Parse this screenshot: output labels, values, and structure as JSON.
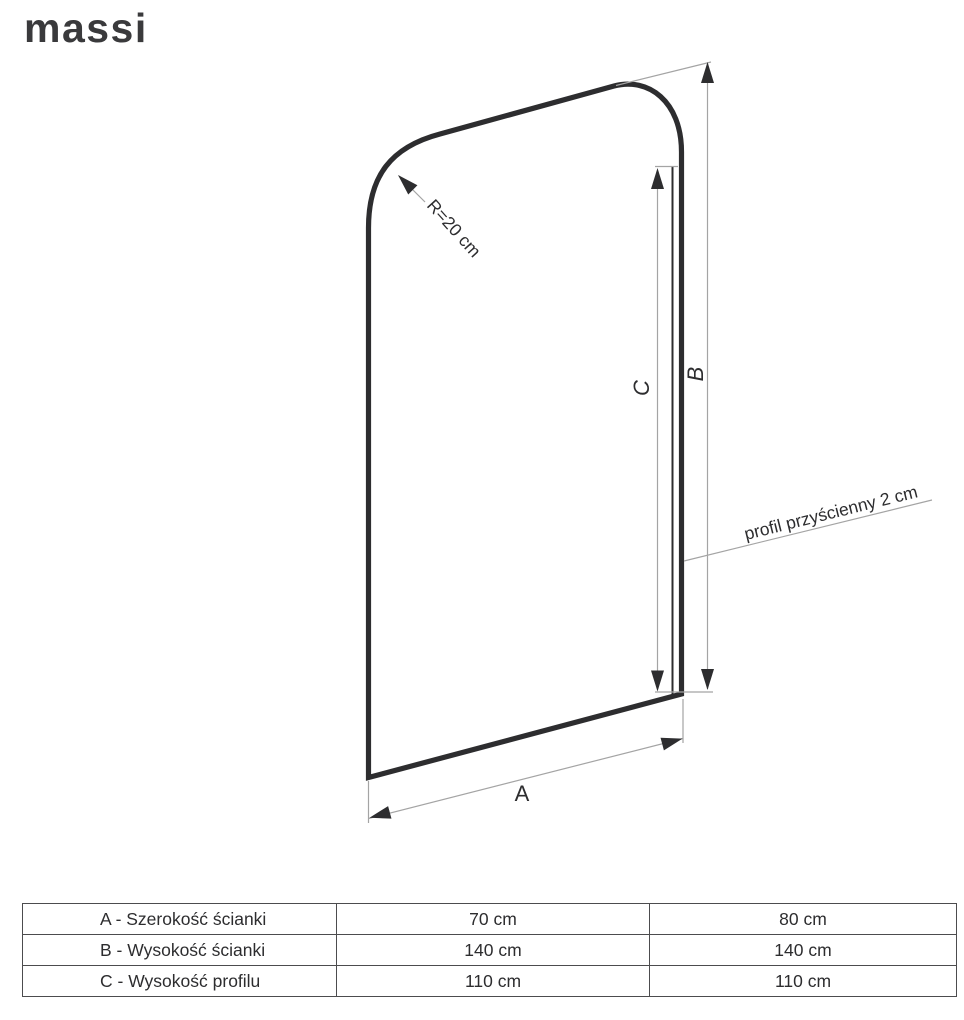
{
  "brand": {
    "logo_text": "massi"
  },
  "diagram": {
    "radius_label": "R=20 cm",
    "profile_label": "profil przyścienny 2 cm",
    "dim_a_label": "A",
    "dim_b_label": "B",
    "dim_c_label": "C",
    "colors": {
      "panel_outline": "#2d2d2f",
      "dimension_line": "#a4a4a4",
      "annotation_text": "#2d2d2f",
      "table_border": "#4c4c4e",
      "logo": "#3a3a3c"
    }
  },
  "table": {
    "rows": [
      {
        "label": "A - Szerokość ścianki",
        "size1": "70 cm",
        "size2": "80 cm"
      },
      {
        "label": "B - Wysokość ścianki",
        "size1": "140 cm",
        "size2": "140 cm"
      },
      {
        "label": "C - Wysokość profilu",
        "size1": "110 cm",
        "size2": "110 cm"
      }
    ]
  }
}
